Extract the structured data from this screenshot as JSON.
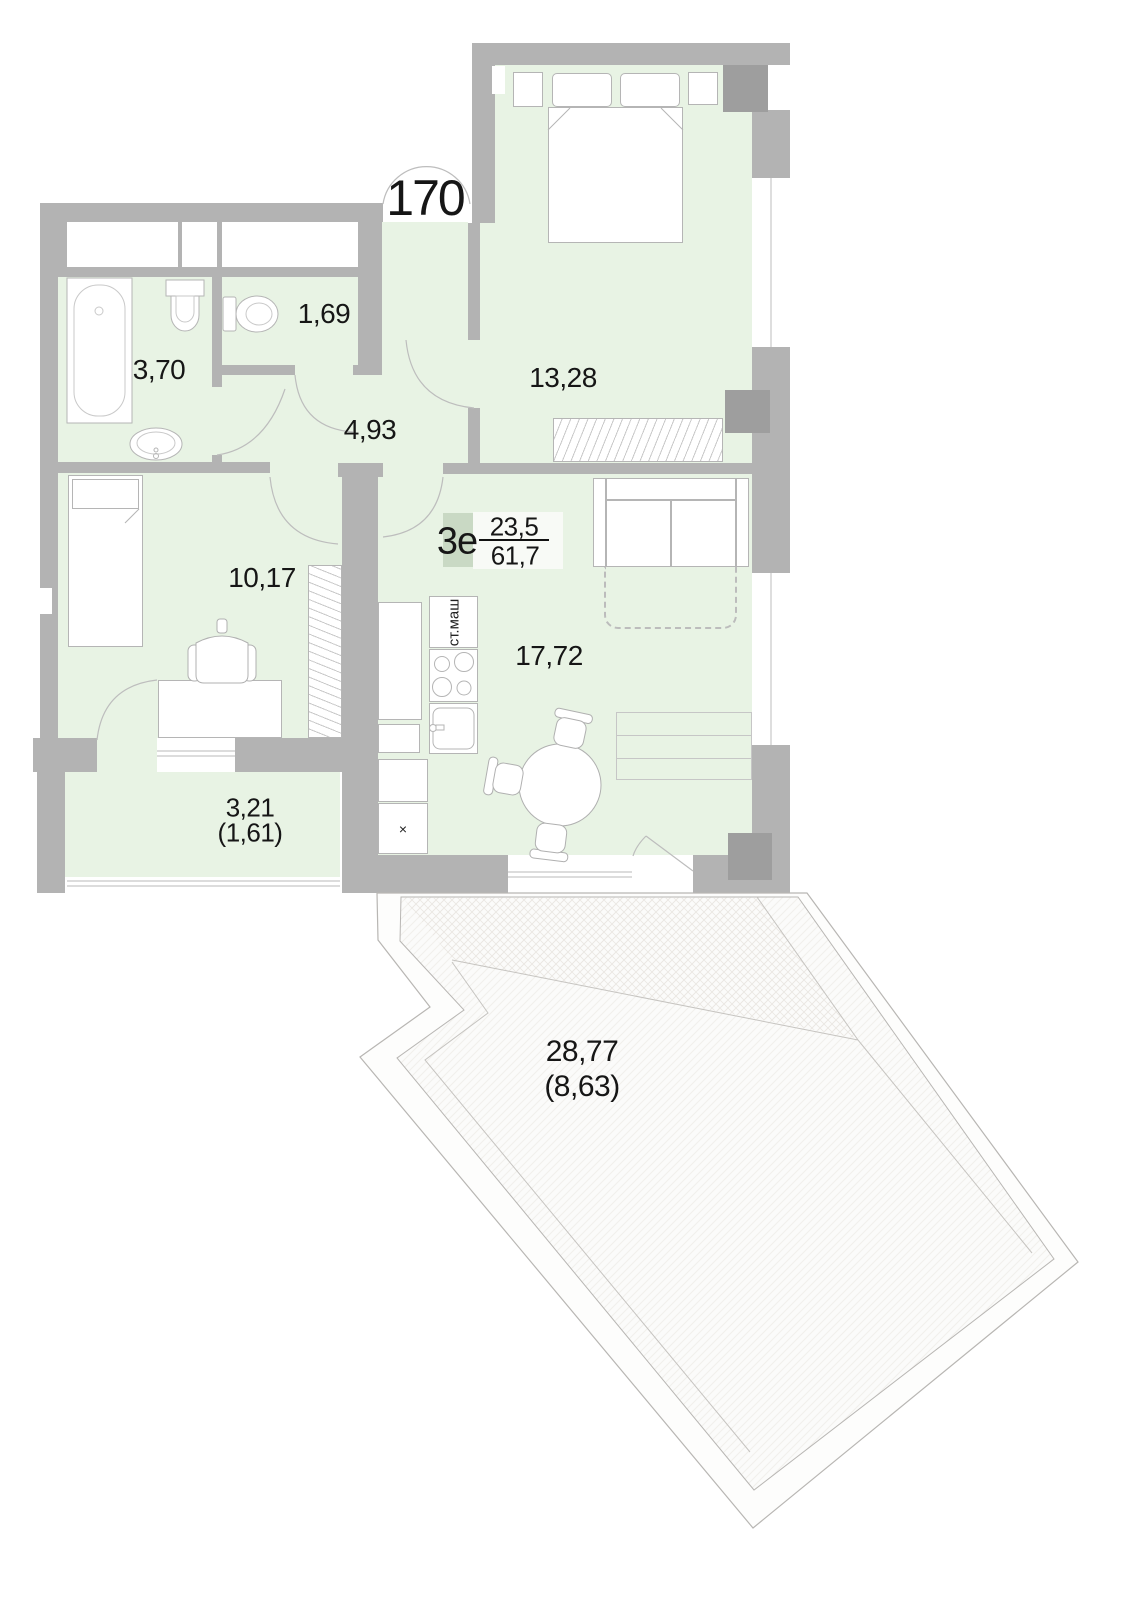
{
  "unit": {
    "number": "170",
    "plan_type": "3е",
    "area_top": "23,5",
    "area_bottom": "61,7"
  },
  "rooms": {
    "bathroom": {
      "name": "bathroom",
      "area": "3,70"
    },
    "wc": {
      "name": "wc",
      "area": "1,69"
    },
    "hall": {
      "name": "hall",
      "area": "4,93"
    },
    "bedroom": {
      "name": "bedroom",
      "area": "13,28"
    },
    "room": {
      "name": "room",
      "area": "10,17"
    },
    "kitchen_living": {
      "name": "kitchen-living room",
      "area": "17,72"
    },
    "balcony": {
      "name": "balcony",
      "area": "3,21",
      "area_coeff": "(1,61)"
    },
    "terrace": {
      "name": "terrace",
      "area": "28,77",
      "area_coeff": "(8,63)"
    }
  },
  "annotations": {
    "washing_machine": "ст.маш",
    "vent_mark": "×"
  },
  "colors": {
    "floor_fill": "#e8f3e4",
    "wall": "#b3b3b3",
    "wall_dark": "#9e9e9e",
    "furniture_outline": "#b5b5b5",
    "plan_code_box": "#c9d9c4"
  }
}
